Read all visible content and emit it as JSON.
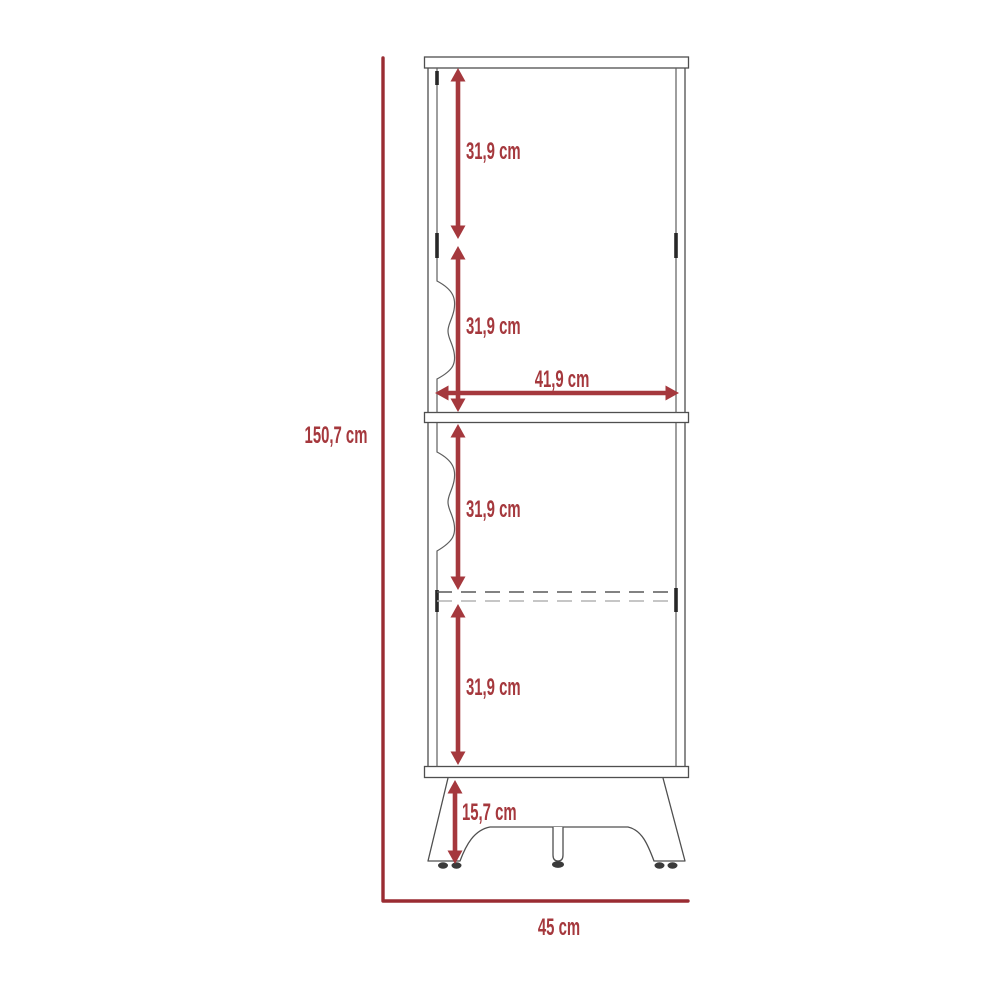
{
  "diagram": {
    "type": "furniture-dimension-diagram",
    "object": "two-door storage cabinet with legs",
    "units": "cm",
    "labels": {
      "total_height": "150,7 cm",
      "upper_section_a": "31,9 cm",
      "upper_section_b": "31,9 cm",
      "inner_width": "41,9 cm",
      "lower_section_a": "31,9 cm",
      "lower_section_b": "31,9 cm",
      "leg_height": "15,7 cm",
      "total_width": "45 cm"
    },
    "colors": {
      "dimension_red": "#a5383d",
      "axis_maroon": "#9a2c32",
      "outline_gray": "#4f4f4f",
      "dashed_dark": "#585858",
      "dashed_light": "#b4b4b4"
    }
  }
}
